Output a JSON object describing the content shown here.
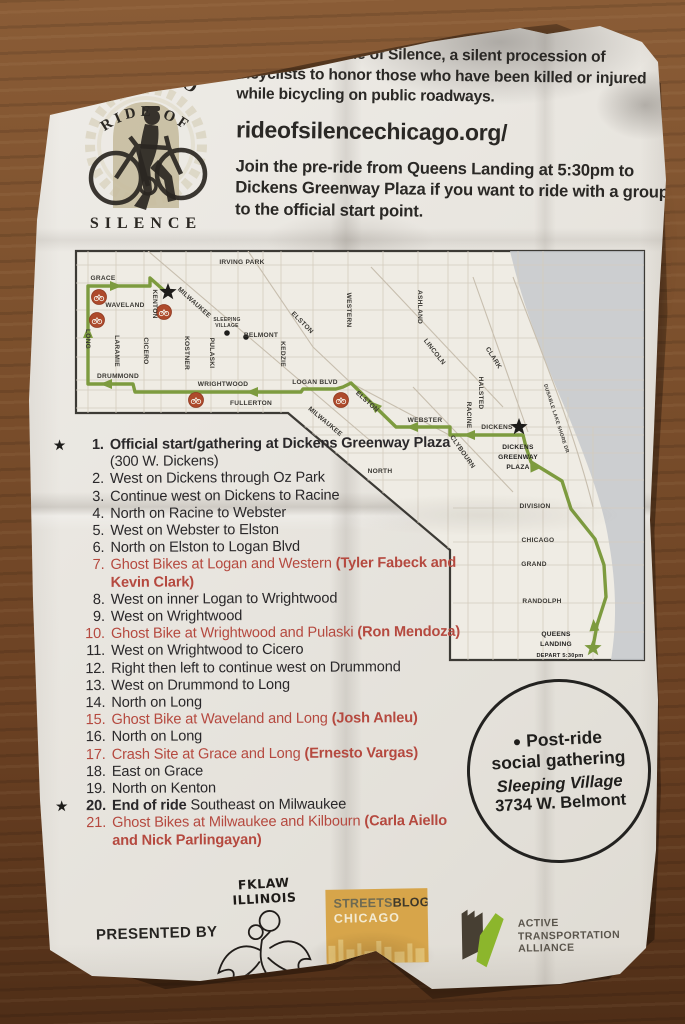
{
  "colors": {
    "accent_red": "#b5493f",
    "route_green": "#7d9b3f",
    "marker_red": "#ae4a2c",
    "streetsblog_gold": "#d7a54a",
    "ata_green": "#8cb62c"
  },
  "header": {
    "logo": {
      "arc_top": "CHICAGO",
      "arc_mid": "RIDE OF",
      "bottom": "SILENCE"
    },
    "intro": "The Chicago Ride of Silence, a silent procession of bicyclists to honor those who have been killed or injured while bicycling on public roadways.",
    "url": "rideofsilencechicago.org/",
    "pre_ride": "Join the pre-ride from Queens Landing at 5:30pm to Dickens Greenway Plaza if you want to ride with a group to the official start point."
  },
  "map": {
    "labels": [
      {
        "t": "IRVING PARK",
        "x": 169,
        "y": 17
      },
      {
        "t": "GRACE",
        "x": 30,
        "y": 33
      },
      {
        "t": "WAVELAND",
        "x": 52,
        "y": 60
      },
      {
        "t": "KENTON",
        "x": 80,
        "y": 57,
        "r": 90
      },
      {
        "t": "MILWAUKEE",
        "x": 120,
        "y": 57,
        "r": 42
      },
      {
        "t": "SLEEPING",
        "x": 154,
        "y": 74,
        "s": 5
      },
      {
        "t": "VILLAGE",
        "x": 154,
        "y": 80,
        "s": 5
      },
      {
        "t": "BELMONT",
        "x": 188,
        "y": 90
      },
      {
        "t": "ELSTON",
        "x": 228,
        "y": 77,
        "r": 45
      },
      {
        "t": "WESTERN",
        "x": 274,
        "y": 63,
        "r": 90
      },
      {
        "t": "ASHLAND",
        "x": 345,
        "y": 60,
        "r": 90
      },
      {
        "t": "LINCOLN",
        "x": 360,
        "y": 106,
        "r": 52
      },
      {
        "t": "CLARK",
        "x": 419,
        "y": 112,
        "r": 58
      },
      {
        "t": "HALSTED",
        "x": 406,
        "y": 146,
        "r": 90
      },
      {
        "t": "KEDZIE",
        "x": 208,
        "y": 107,
        "r": 90
      },
      {
        "t": "LONG",
        "x": 13,
        "y": 92,
        "r": 90
      },
      {
        "t": "LARAMIE",
        "x": 42,
        "y": 104,
        "r": 90
      },
      {
        "t": "CICERO",
        "x": 71,
        "y": 104,
        "r": 90
      },
      {
        "t": "KOSTNER",
        "x": 112,
        "y": 106,
        "r": 90
      },
      {
        "t": "PULASKI",
        "x": 137,
        "y": 106,
        "r": 90
      },
      {
        "t": "DRUMMOND",
        "x": 45,
        "y": 131
      },
      {
        "t": "WRIGHTWOOD",
        "x": 150,
        "y": 139
      },
      {
        "t": "LOGAN BLVD",
        "x": 242,
        "y": 137
      },
      {
        "t": "FULLERTON",
        "x": 178,
        "y": 158
      },
      {
        "t": "MILWAUKEE",
        "x": 251,
        "y": 176,
        "r": 40
      },
      {
        "t": "ELSTON",
        "x": 293,
        "y": 156,
        "r": 42
      },
      {
        "t": "WEBSTER",
        "x": 352,
        "y": 175
      },
      {
        "t": "RACINE",
        "x": 394,
        "y": 168,
        "r": 90
      },
      {
        "t": "CLYBOURN",
        "x": 388,
        "y": 206,
        "r": 55
      },
      {
        "t": "DICKENS",
        "x": 424,
        "y": 182
      },
      {
        "t": "NORTH",
        "x": 307,
        "y": 226
      },
      {
        "t": "DUSABLE LAKE SHORE DR",
        "x": 482,
        "y": 172,
        "r": 72,
        "s": 5
      },
      {
        "t": "DIVISION",
        "x": 462,
        "y": 261
      },
      {
        "t": "CHICAGO",
        "x": 465,
        "y": 295
      },
      {
        "t": "GRAND",
        "x": 461,
        "y": 319
      },
      {
        "t": "RANDOLPH",
        "x": 469,
        "y": 356
      },
      {
        "t": "DICKENS",
        "x": 445,
        "y": 202,
        "b": 1
      },
      {
        "t": "GREENWAY",
        "x": 445,
        "y": 212,
        "b": 1
      },
      {
        "t": "PLAZA",
        "x": 445,
        "y": 222,
        "b": 1
      },
      {
        "t": "QUEENS",
        "x": 483,
        "y": 389,
        "b": 1
      },
      {
        "t": "LANDING",
        "x": 483,
        "y": 399,
        "b": 1
      },
      {
        "t": "DEPART 5:30pm",
        "x": 487,
        "y": 410,
        "s": 5.6,
        "b": 1
      }
    ],
    "route": [
      [
        520,
        400
      ],
      [
        524,
        378
      ],
      [
        533,
        350
      ],
      [
        531,
        318
      ],
      [
        522,
        292
      ],
      [
        498,
        262
      ],
      [
        489,
        234
      ],
      [
        458,
        215
      ],
      [
        453,
        200
      ],
      [
        450,
        188
      ],
      [
        377,
        188
      ],
      [
        377,
        180
      ],
      [
        323,
        180
      ],
      [
        278,
        136
      ],
      [
        270,
        140
      ],
      [
        263,
        142
      ],
      [
        230,
        142
      ],
      [
        228,
        145
      ],
      [
        62,
        145
      ],
      [
        60,
        137
      ],
      [
        15,
        137
      ],
      [
        15,
        39
      ],
      [
        77,
        39
      ],
      [
        77,
        31
      ],
      [
        95,
        47
      ]
    ],
    "arrows": [
      {
        "x": 42,
        "y": 39,
        "a": 0
      },
      {
        "x": 15,
        "y": 86,
        "a": -90
      },
      {
        "x": 34,
        "y": 137,
        "a": 180
      },
      {
        "x": 180,
        "y": 145,
        "a": 180
      },
      {
        "x": 302,
        "y": 159,
        "a": -136
      },
      {
        "x": 340,
        "y": 180,
        "a": 180
      },
      {
        "x": 397,
        "y": 188,
        "a": 180
      },
      {
        "x": 460,
        "y": 219,
        "a": -115
      },
      {
        "x": 521,
        "y": 379,
        "a": -95
      }
    ],
    "ghost_bike_markers": [
      {
        "x": 26,
        "y": 50
      },
      {
        "x": 24,
        "y": 73
      },
      {
        "x": 91,
        "y": 65
      },
      {
        "x": 123,
        "y": 153
      },
      {
        "x": 268,
        "y": 153
      }
    ],
    "stars": [
      {
        "x": 95,
        "y": 45,
        "c": "#1d1c1a"
      },
      {
        "x": 446,
        "y": 180,
        "c": "#1d1c1a"
      },
      {
        "x": 520,
        "y": 401,
        "c": "#7d9b3f"
      }
    ],
    "dots": [
      {
        "x": 154,
        "y": 86
      },
      {
        "x": 173,
        "y": 90
      }
    ]
  },
  "route_list": {
    "items": [
      {
        "num": "1.",
        "star": true,
        "seg": [
          {
            "t": "Official start/gathering at Dickens Greenway Plaza",
            "b": true
          },
          {
            "t": " (300 W. Dickens)",
            "b": false
          }
        ]
      },
      {
        "num": "2.",
        "seg": [
          {
            "t": "West on Dickens through Oz Park",
            "b": false
          }
        ]
      },
      {
        "num": "3.",
        "seg": [
          {
            "t": "Continue west on Dickens to Racine",
            "b": false
          }
        ]
      },
      {
        "num": "4.",
        "seg": [
          {
            "t": "North on Racine to Webster",
            "b": false
          }
        ]
      },
      {
        "num": "5.",
        "seg": [
          {
            "t": "West on Webster to Elston",
            "b": false
          }
        ]
      },
      {
        "num": "6.",
        "seg": [
          {
            "t": "North on Elston to Logan Blvd",
            "b": false
          }
        ]
      },
      {
        "num": "7.",
        "red": true,
        "seg": [
          {
            "t": "Ghost Bikes at Logan and Western ",
            "b": false
          },
          {
            "t": "(Tyler Fabeck and Kevin Clark)",
            "b": true
          }
        ]
      },
      {
        "num": "8.",
        "seg": [
          {
            "t": "West on inner Logan to Wrightwood",
            "b": false
          }
        ]
      },
      {
        "num": "9.",
        "seg": [
          {
            "t": "West on Wrightwood",
            "b": false
          }
        ]
      },
      {
        "num": "10.",
        "red": true,
        "seg": [
          {
            "t": "Ghost Bike at Wrightwood and Pulaski ",
            "b": false
          },
          {
            "t": "(Ron Mendoza)",
            "b": true
          }
        ]
      },
      {
        "num": "11.",
        "seg": [
          {
            "t": "West on Wrightwood to Cicero",
            "b": false
          }
        ]
      },
      {
        "num": "12.",
        "seg": [
          {
            "t": "Right then left to continue west on Drummond",
            "b": false
          }
        ]
      },
      {
        "num": "13.",
        "seg": [
          {
            "t": "West on Drummond to Long",
            "b": false
          }
        ]
      },
      {
        "num": "14.",
        "seg": [
          {
            "t": "North on Long",
            "b": false
          }
        ]
      },
      {
        "num": "15.",
        "red": true,
        "seg": [
          {
            "t": "Ghost Bike at Waveland and Long ",
            "b": false
          },
          {
            "t": "(Josh Anleu)",
            "b": true
          }
        ]
      },
      {
        "num": "16.",
        "seg": [
          {
            "t": "North on Long",
            "b": false
          }
        ]
      },
      {
        "num": "17.",
        "red": true,
        "seg": [
          {
            "t": "Crash Site at Grace and Long ",
            "b": false
          },
          {
            "t": "(Ernesto Vargas)",
            "b": true
          }
        ]
      },
      {
        "num": "18.",
        "seg": [
          {
            "t": "East on Grace",
            "b": false
          }
        ]
      },
      {
        "num": "19.",
        "seg": [
          {
            "t": "North on Kenton",
            "b": false
          }
        ]
      },
      {
        "num": "20.",
        "star": true,
        "seg": [
          {
            "t": "End of ride ",
            "b": true
          },
          {
            "t": "Southeast on Milwaukee",
            "b": false
          }
        ]
      },
      {
        "num": "21.",
        "red": true,
        "seg": [
          {
            "t": "Ghost Bikes at Milwaukee and Kilbourn ",
            "b": false
          },
          {
            "t": "(Carla Aiello and Nick Parlingayan)",
            "b": true
          }
        ]
      }
    ]
  },
  "post_ride": {
    "bullet": "●",
    "line1": "Post-ride",
    "line2": "social gathering",
    "venue": "Sleeping Village",
    "address": "3734 W. Belmont"
  },
  "footer": {
    "presented_by": "PRESENTED BY",
    "fklaw": "FKLAW ILLINOIS",
    "streetsblog_line1a": "STREETS",
    "streetsblog_line1b": "BLOG",
    "streetsblog_line2": "CHICAGO",
    "ata_line1": "ACTIVE",
    "ata_line2": "TRANSPORTATION",
    "ata_line3": "ALLIANCE"
  }
}
